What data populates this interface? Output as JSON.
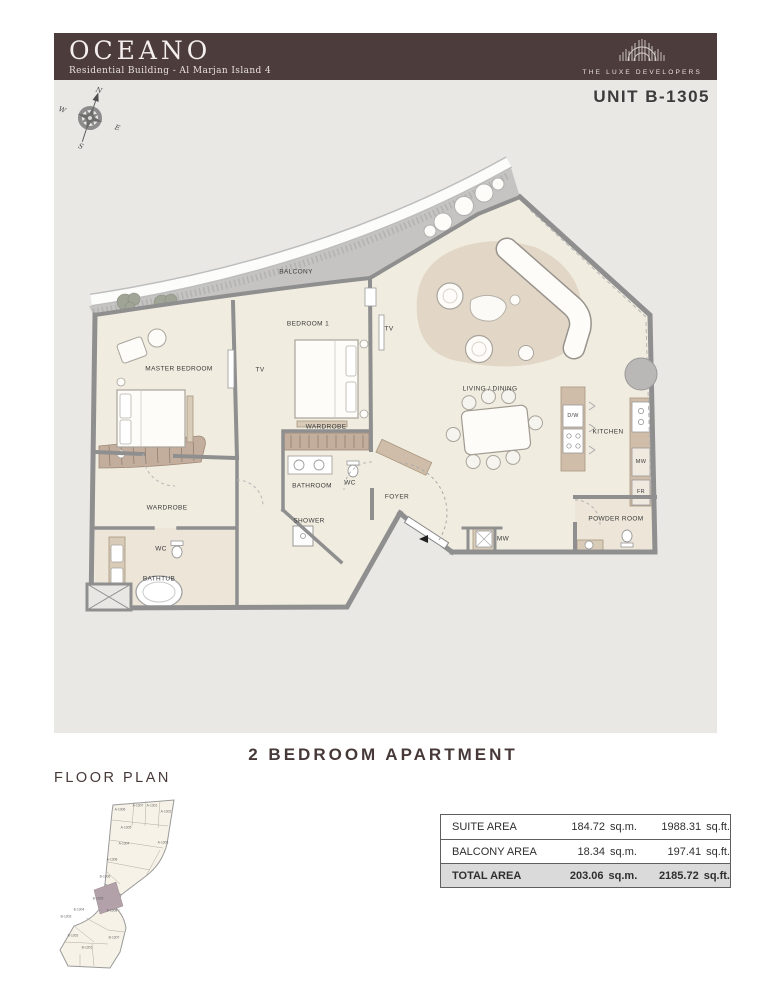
{
  "header": {
    "brand": "OCEANO",
    "subtitle": "Residential Building - Al Marjan Island 4",
    "developer": "THE LUXE DEVELOPERS"
  },
  "unit_label": "UNIT B-1305",
  "title": "2 BEDROOM APARTMENT",
  "floor_plan_heading": "FLOOR PLAN",
  "compass": {
    "n": "N",
    "e": "E",
    "s": "S",
    "w": "W"
  },
  "colors": {
    "header_bg": "#4c3c3b",
    "canvas_bg": "#e9e8e5",
    "floor": "#f1ece0",
    "wall": "#939393",
    "accent_tan": "#cfbda9",
    "wardrobe_band": "#c3ad9d",
    "keyplan_highlight": "#b3a1a9",
    "total_row_bg": "#dadada"
  },
  "plan_labels": [
    {
      "text": "BALCONY",
      "x": 213,
      "y": 122
    },
    {
      "text": "MASTER BEDROOM",
      "x": 96,
      "y": 219
    },
    {
      "text": "BEDROOM 1",
      "x": 225,
      "y": 174
    },
    {
      "text": "TV",
      "x": 177,
      "y": 220
    },
    {
      "text": "TV",
      "x": 306,
      "y": 179
    },
    {
      "text": "LIVING / DINING",
      "x": 407,
      "y": 239
    },
    {
      "text": "KITCHEN",
      "x": 525,
      "y": 282
    },
    {
      "text": "FOYER",
      "x": 314,
      "y": 347
    },
    {
      "text": "WARDROBE",
      "x": 84,
      "y": 358
    },
    {
      "text": "WARDROBE",
      "x": 243,
      "y": 277
    },
    {
      "text": "BATHROOM",
      "x": 229,
      "y": 336
    },
    {
      "text": "SHOWER",
      "x": 226,
      "y": 371
    },
    {
      "text": "WC",
      "x": 78,
      "y": 399
    },
    {
      "text": "WC",
      "x": 267,
      "y": 333
    },
    {
      "text": "BATHTUB",
      "x": 76,
      "y": 429
    },
    {
      "text": "POWDER ROOM",
      "x": 533,
      "y": 369
    },
    {
      "text": "MW",
      "x": 420,
      "y": 389
    },
    {
      "text": "MW",
      "x": 558,
      "y": 312,
      "s": 5.5
    },
    {
      "text": "FR",
      "x": 558,
      "y": 342,
      "s": 5.5
    },
    {
      "text": "D/W",
      "x": 490,
      "y": 266,
      "s": 5.2
    }
  ],
  "key_plan": {
    "highlight_unit": "B-1305",
    "units": [
      {
        "id": "A-1306",
        "x": 70,
        "y": 18
      },
      {
        "id": "A-1307",
        "x": 88,
        "y": 14
      },
      {
        "id": "A-1301",
        "x": 102,
        "y": 14
      },
      {
        "id": "A-1302",
        "x": 116,
        "y": 20
      },
      {
        "id": "A-1305",
        "x": 76,
        "y": 36
      },
      {
        "id": "A-1304",
        "x": 74,
        "y": 52
      },
      {
        "id": "A-1303",
        "x": 113,
        "y": 51
      },
      {
        "id": "A-1308",
        "x": 62,
        "y": 68
      },
      {
        "id": "B-1306",
        "x": 55,
        "y": 85
      },
      {
        "id": "B-1305",
        "x": 48,
        "y": 107
      },
      {
        "id": "B-1304",
        "x": 29,
        "y": 118
      },
      {
        "id": "B-1303",
        "x": 16,
        "y": 125
      },
      {
        "id": "B-1308",
        "x": 62,
        "y": 119
      },
      {
        "id": "B-1302",
        "x": 23,
        "y": 144
      },
      {
        "id": "B-1307",
        "x": 64,
        "y": 146
      },
      {
        "id": "B-1301",
        "x": 37,
        "y": 156
      }
    ]
  },
  "area_table": {
    "rows": [
      {
        "label": "SUITE AREA",
        "sqm": "184.72",
        "sqm_unit": "sq.m.",
        "sqft": "1988.31",
        "sqft_unit": "sq.ft.",
        "total": false
      },
      {
        "label": "BALCONY AREA",
        "sqm": "18.34",
        "sqm_unit": "sq.m.",
        "sqft": "197.41",
        "sqft_unit": "sq.ft.",
        "total": false
      },
      {
        "label": "TOTAL AREA",
        "sqm": "203.06",
        "sqm_unit": "sq.m.",
        "sqft": "2185.72",
        "sqft_unit": "sq.ft.",
        "total": true
      }
    ]
  }
}
